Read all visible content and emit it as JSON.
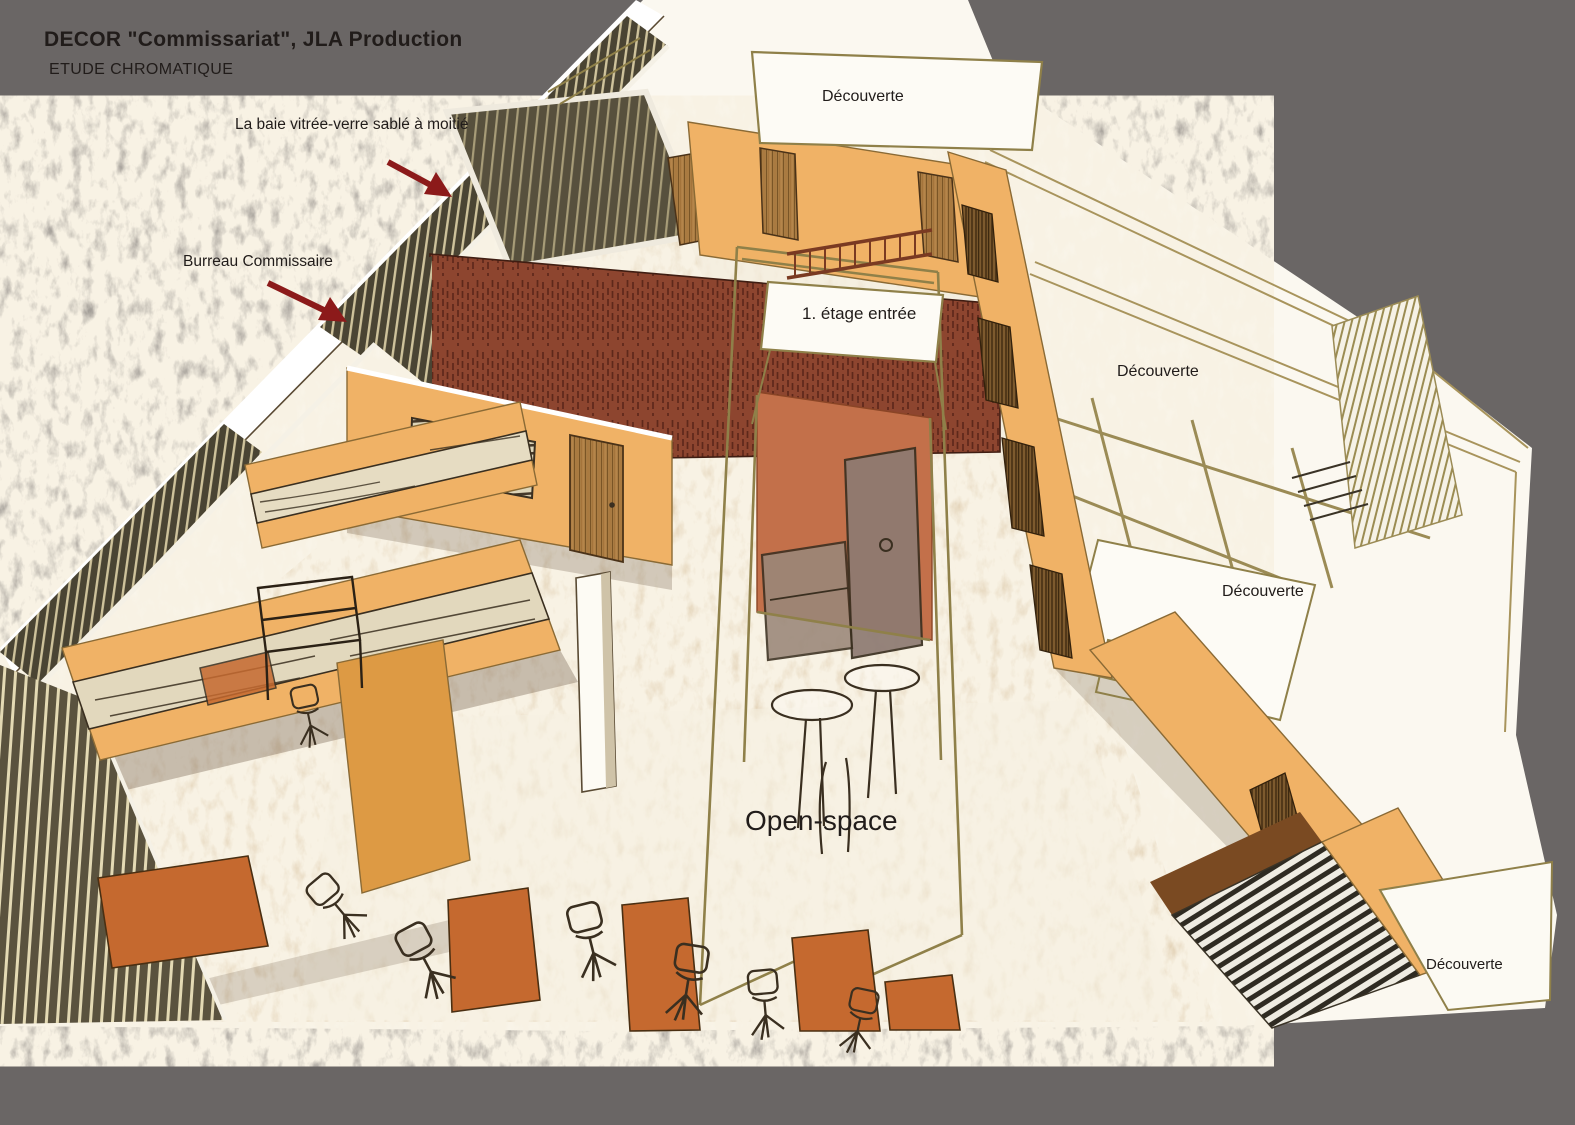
{
  "title": {
    "line1": "DECOR \"Commissariat\", JLA Production",
    "line2": "ETUDE CHROMATIQUE"
  },
  "annotations": {
    "baie_vitree": "La baie vitrée-verre sablé à moitié",
    "bureau_commissaire": "Burreau Commissaire"
  },
  "room_labels": {
    "decouverte_top": "Découverte",
    "etage_entree": "1. étage entrée",
    "decouverte_right_upper": "Découverte",
    "decouverte_right_mid": "Découverte",
    "open_space": "Open-space",
    "decouverte_bottom_right": "Découverte"
  },
  "palette": {
    "background_gray": "#6a6665",
    "paper_white": "#fbf8f0",
    "floor_beige": "#d8c2a0",
    "floor_pale": "#f3ecdd",
    "wall_orange": "#f0b266",
    "wall_orange_light": "#f7d08f",
    "wall_orange_dark": "#dd9a44",
    "red_wall": "#8d452f",
    "terracotta": "#c3704a",
    "door_wood": "#b5854a",
    "door_wood_dark": "#7a5526",
    "desk_wood": "#c5692f",
    "sketch_line": "#3a2f20",
    "frame_khaki": "#8f8049",
    "cabinet_gray": "#8d7a72",
    "sofa_gray": "#9a8779",
    "arrow_red": "#8c1a1a",
    "text_dark": "#211c1a",
    "shadow_brown": "#5f4c38"
  }
}
